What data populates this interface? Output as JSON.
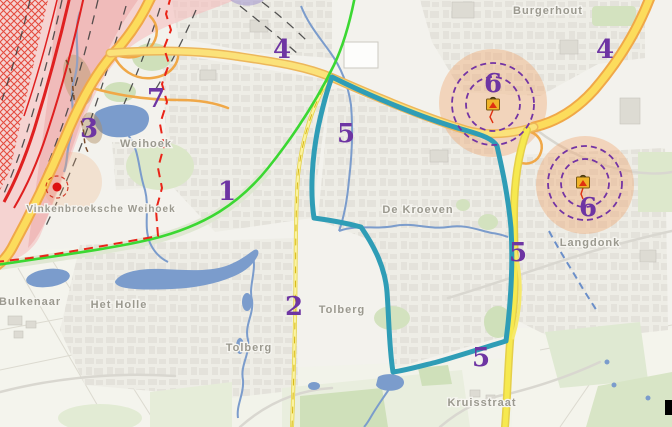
{
  "map": {
    "type": "street-map-with-risk-annotations",
    "place_labels": [
      {
        "id": "burgerhout",
        "text": "Burgerhout"
      },
      {
        "id": "weihoek",
        "text": "Weihoek"
      },
      {
        "id": "vinkenbroeksche-weihoek",
        "text": "Vinkenbroeksche Weihoek"
      },
      {
        "id": "de-kroeven",
        "text": "De Kroeven"
      },
      {
        "id": "langdonk",
        "text": "Langdonk"
      },
      {
        "id": "bulkenaar",
        "text": "Bulkenaar"
      },
      {
        "id": "het-holle",
        "text": "Het Holle"
      },
      {
        "id": "tolberg-west",
        "text": "Tolberg"
      },
      {
        "id": "tolberg-east",
        "text": "Tolberg"
      },
      {
        "id": "kruisstraat",
        "text": "Kruisstraat"
      }
    ],
    "zone_numbers": [
      {
        "n": "1"
      },
      {
        "n": "2"
      },
      {
        "n": "3"
      },
      {
        "n": "4"
      },
      {
        "n": "4"
      },
      {
        "n": "5"
      },
      {
        "n": "5"
      },
      {
        "n": "5"
      },
      {
        "n": "6"
      },
      {
        "n": "6"
      },
      {
        "n": "7"
      }
    ],
    "hazard_markers": [
      {
        "zone_number": "6",
        "icon": "lpg-tank-hazard-icon",
        "rings": 2
      },
      {
        "zone_number": "6",
        "icon": "lpg-tank-hazard-icon",
        "rings": 2
      }
    ],
    "colors": {
      "zone_number_purple": "#6e35a3",
      "place_label_gray": "#9b998f",
      "study_area_outline_teal": "#2f9db6",
      "highway_yellow": "#fcdc5c",
      "highway_casing_orange": "#f0a848",
      "boundary_green_line": "#3bd832",
      "boundary_red_dashed": "#ea2418",
      "risk_zone_orange_fill": "#f2a268",
      "risk_ring_purple_dashed": "#7434a4",
      "railway_zone_pink": "#f5b9b9",
      "water_blue": "#7b9ccc",
      "hazard_point_red": "#dd1111"
    }
  }
}
